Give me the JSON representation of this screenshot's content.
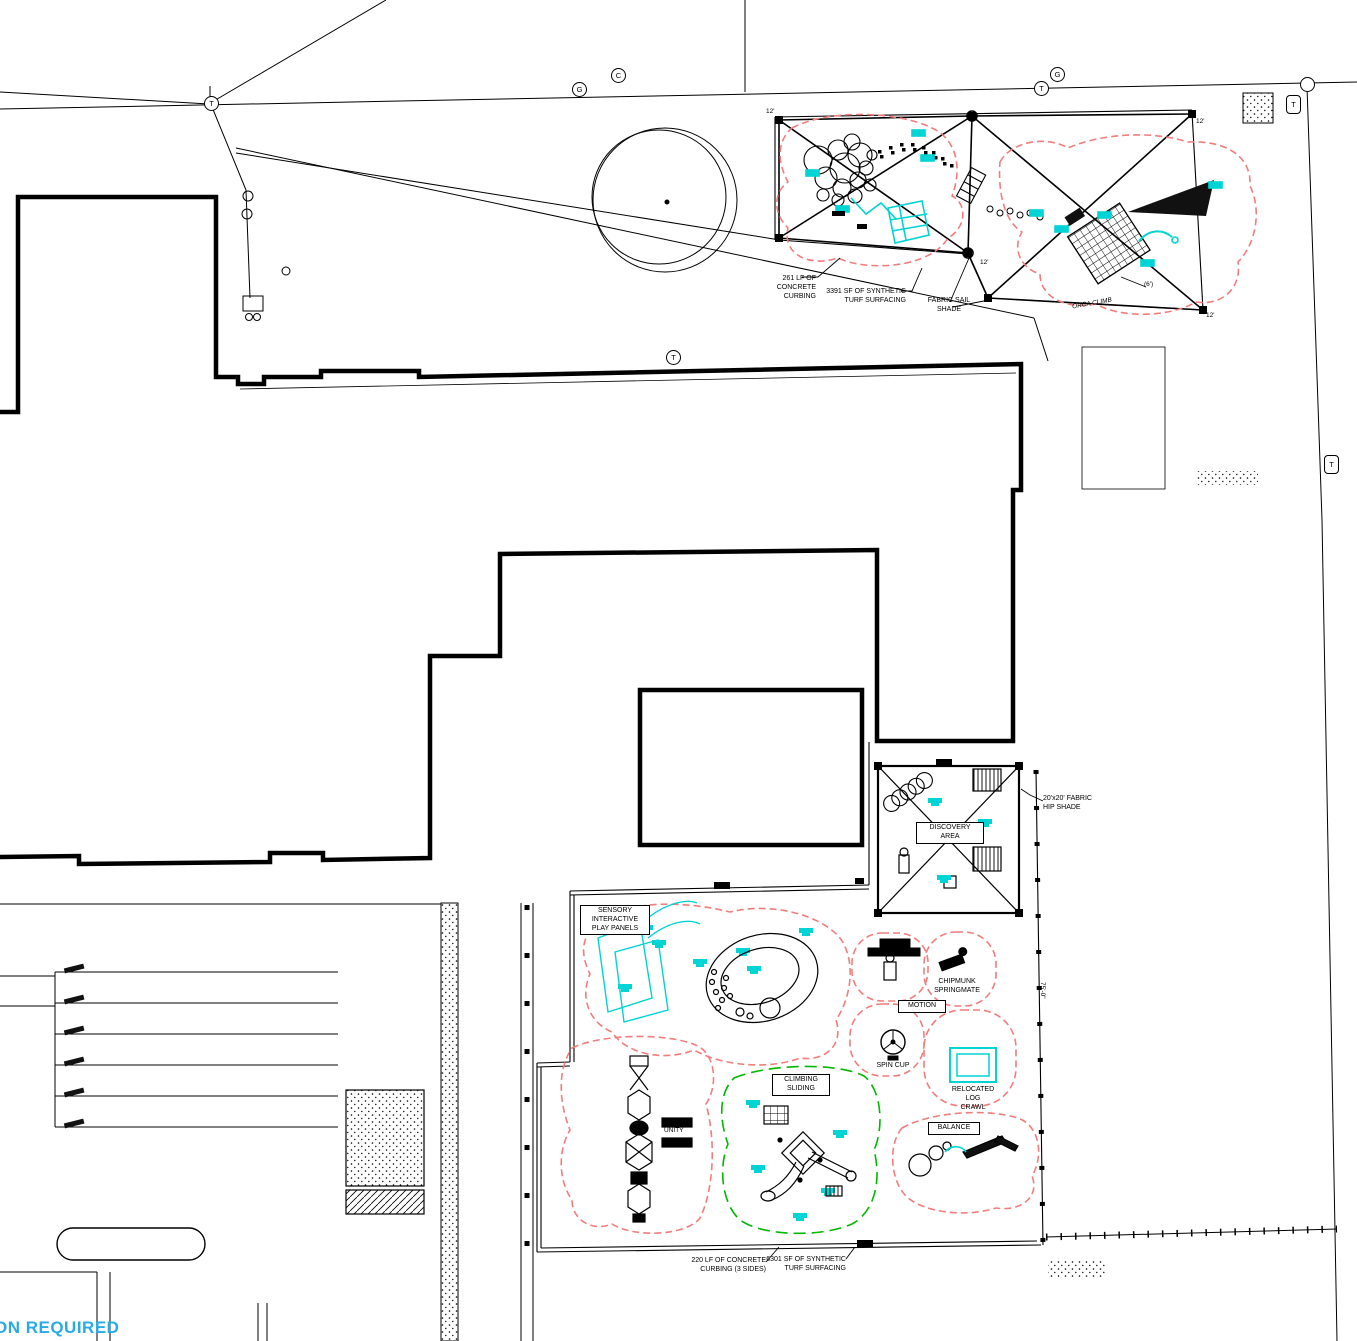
{
  "colors": {
    "equipment_cyan": "#00D4D4",
    "safety_zone_dashed_pink": "#F27D7D",
    "proposed_dashed_green": "#00B800",
    "note_blue": "#29ABE2",
    "linework_black": "#000000"
  },
  "utility_markers": [
    {
      "letter": "T"
    },
    {
      "letter": "G"
    },
    {
      "letter": "C"
    },
    {
      "letter": "T"
    },
    {
      "letter": "G"
    },
    {
      "letter": "T"
    },
    {
      "letter": "T"
    },
    {
      "letter": "T"
    }
  ],
  "upper_playground": {
    "curbing_note": "261 LF OF CONCRETE\nCURBING",
    "turf_note": "3391 SF OF SYNTHETIC\nTURF SURFACING",
    "shade_note": "FABRIC SAIL\nSHADE",
    "climb_note": "ORCA CLIMB",
    "dim_note": "(6')",
    "post_height": "12'"
  },
  "lower_playground": {
    "discovery_label": "DISCOVERY\nAREA",
    "hip_shade_note": "20'x20' FABRIC\nHIP SHADE",
    "sensory_label": "SENSORY\nINTERACTIVE\nPLAY PANELS",
    "motion_label": "MOTION",
    "chipmunk_note": "CHIPMUNK\nSPRINGMATE",
    "spin_cup_note": "SPIN CUP",
    "log_crawl_note": "RELOCATED\nLOG\nCRAWL",
    "balance_label": "BALANCE",
    "unity_note": "UNITY",
    "climbing_label": "CLIMBING\nSLIDING",
    "curbing_note": "220 LF OF CONCRETE\nCURBING (3 SIDES)",
    "turf_note": "6301 SF OF SYNTHETIC\nTURF SURFACING",
    "width_dim": "75'-0\""
  },
  "site_note_partial": "ON REQUIRED"
}
